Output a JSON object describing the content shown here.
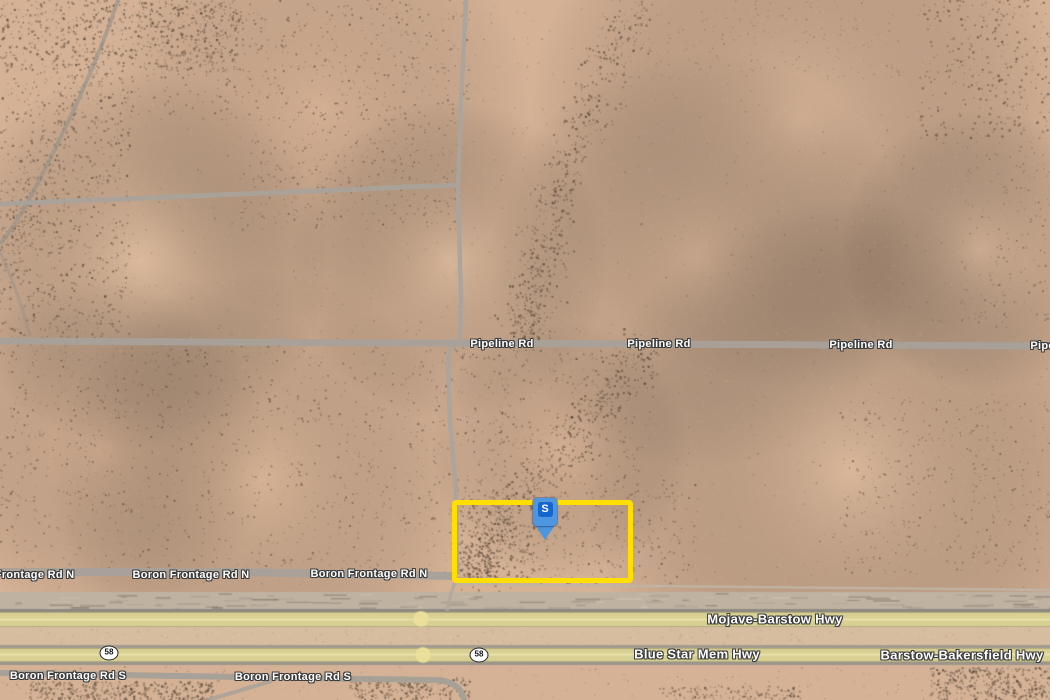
{
  "map": {
    "kind": "satellite",
    "parcel": {
      "outline_color": "#FFDE00"
    },
    "marker": {
      "label": "S",
      "body_color": "#4E96DF",
      "badge_color": "#1565CE",
      "letter_color": "#FFFFFF"
    },
    "highway_color": "#D8D092",
    "road_labels": [
      {
        "text": "Pipeline Rd",
        "kind": "road",
        "x": 502,
        "y": 344
      },
      {
        "text": "Pipeline Rd",
        "kind": "road",
        "x": 659,
        "y": 344
      },
      {
        "text": "Pipeline Rd",
        "kind": "road",
        "x": 861,
        "y": 345
      },
      {
        "text": "Pipeline Rd",
        "kind": "road",
        "x": 1062,
        "y": 346
      },
      {
        "text": "Boron Frontage Rd N",
        "kind": "road",
        "x": 16,
        "y": 575
      },
      {
        "text": "Boron Frontage Rd N",
        "kind": "road",
        "x": 191,
        "y": 575
      },
      {
        "text": "Boron Frontage Rd N",
        "kind": "road",
        "x": 369,
        "y": 574
      },
      {
        "text": "Mojave-Barstow Hwy",
        "kind": "highway",
        "x": 775,
        "y": 619
      },
      {
        "text": "Blue Star Mem Hwy",
        "kind": "highway",
        "x": 697,
        "y": 654
      },
      {
        "text": "Barstow-Bakersfield Hwy",
        "kind": "highway",
        "x": 962,
        "y": 655
      },
      {
        "text": "Boron Frontage Rd S",
        "kind": "road",
        "x": 68,
        "y": 676
      },
      {
        "text": "Boron Frontage Rd S",
        "kind": "road",
        "x": 293,
        "y": 677
      }
    ],
    "route_shields": [
      {
        "text": "58",
        "x": 109,
        "y": 653
      },
      {
        "text": "58",
        "x": 479,
        "y": 655
      }
    ],
    "route_dots": [
      {
        "x": 421,
        "y": 619
      },
      {
        "x": 423,
        "y": 655
      }
    ]
  }
}
